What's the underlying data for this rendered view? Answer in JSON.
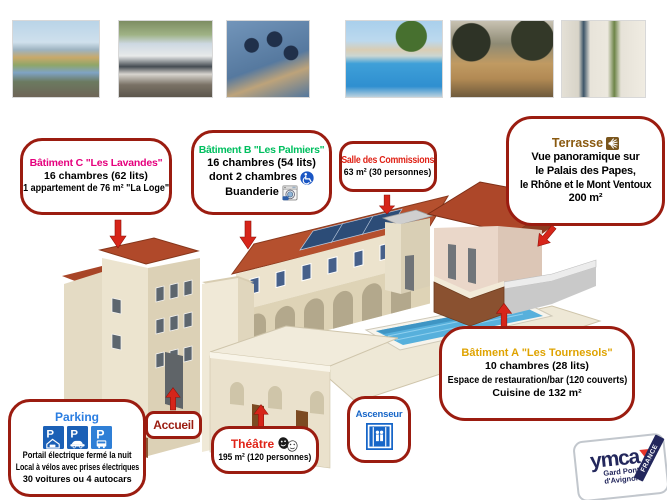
{
  "colors": {
    "box_border": "#9b1c10",
    "arrow_red": "#d6251a",
    "magenta": "#e5007d",
    "green": "#00bf5f",
    "red": "#e02317",
    "brown": "#8a5a10",
    "gold": "#dfa300",
    "blue": "#2a7de1",
    "dark_red": "#9b1c10",
    "elevator_blue": "#1766c8"
  },
  "photos": [
    {
      "name": "panorama-rhone"
    },
    {
      "name": "autocar"
    },
    {
      "name": "groupe-gymnase"
    },
    {
      "name": "piscine"
    },
    {
      "name": "terrasse-arboree"
    },
    {
      "name": "entree-batiment"
    }
  ],
  "callouts": {
    "batiment_c": {
      "title": "Bâtiment C \"Les Lavandes\"",
      "lines": [
        "16 chambres (62 lits)",
        "1 appartement de 76 m² \"La Loge\""
      ]
    },
    "batiment_b": {
      "title": "Bâtiment B \"Les Palmiers\"",
      "lines": [
        "16 chambres (54 lits)",
        "dont 2 chambres",
        "Buanderie"
      ]
    },
    "salle_commissions": {
      "title": "Salle des Commissions",
      "lines": [
        "63 m² (30 personnes)"
      ]
    },
    "terrasse": {
      "title": "Terrasse",
      "lines": [
        "Vue panoramique sur",
        "le Palais des Papes,",
        "le Rhône et le Mont Ventoux",
        "200 m²"
      ]
    },
    "batiment_a": {
      "title": "Bâtiment A \"Les Tournesols\"",
      "lines": [
        "10 chambres (28 lits)",
        "Espace de restauration/bar (120 couverts)",
        "Cuisine de 132 m²"
      ]
    },
    "parking": {
      "title": "Parking",
      "sign_letter": "P",
      "lines": [
        "Portail électrique fermé la nuit",
        "Local à vélos avec prises électriques",
        "30 voitures ou 4 autocars"
      ]
    },
    "accueil": {
      "title": "Accueil"
    },
    "theatre": {
      "title": "Théâtre",
      "lines": [
        "195 m² (120 personnes)"
      ]
    },
    "ascenseur": {
      "title": "Ascenseur"
    }
  },
  "logo": {
    "brand": "ymca",
    "region_line1": "Gard Pont",
    "region_line2": "d'Avignon",
    "ribbon": "FRANCE"
  }
}
